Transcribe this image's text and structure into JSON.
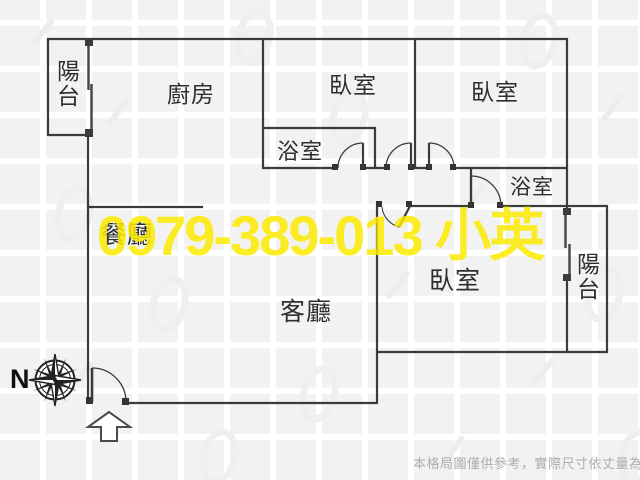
{
  "watermark": {
    "text": "0979-389-013 小英",
    "color": "#fdea00"
  },
  "rooms": {
    "balcony_top_left": "陽台",
    "kitchen": "廚房",
    "bedroom_top": "臥室",
    "bedroom_top_right": "臥室",
    "bathroom_hall": "浴室",
    "bathroom_ensuite": "浴室",
    "dining": "餐廳",
    "living": "客廳",
    "bedroom_right": "臥室",
    "balcony_right": "陽台"
  },
  "compass": {
    "label": "N"
  },
  "footer": {
    "disclaimer": "本格局圖僅供參考，實際尺寸依丈量為準"
  },
  "colors": {
    "walls": "#3b3b3b",
    "watermark": "#fdea00",
    "disclaimer_text": "#a9aeae",
    "background_tile": "#f2f2f3"
  }
}
